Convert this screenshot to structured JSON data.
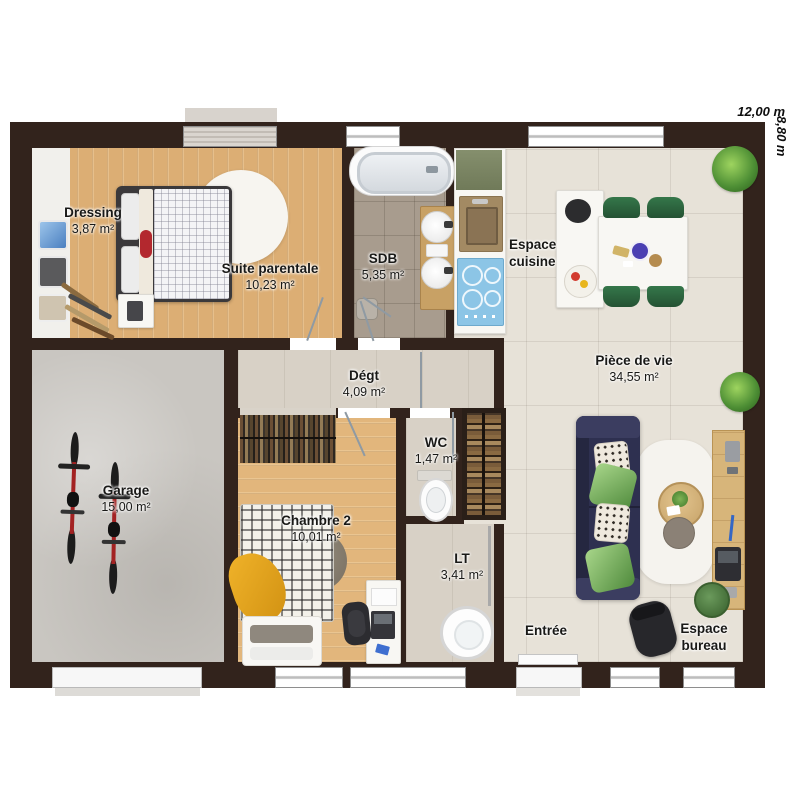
{
  "plan": {
    "dimension_width": "12,00 m",
    "dimension_height": "8,80 m",
    "rooms": [
      {
        "name": "Dressing",
        "area": "3,87 m²"
      },
      {
        "name": "Suite parentale",
        "area": "10,23 m²"
      },
      {
        "name": "SDB",
        "area": "5,35 m²"
      },
      {
        "name": "Espace cuisine",
        "area": ""
      },
      {
        "name": "Pièce de vie",
        "area": "34,55 m²"
      },
      {
        "name": "Dégt",
        "area": "4,09 m²"
      },
      {
        "name": "Garage",
        "area": "15,00 m²"
      },
      {
        "name": "Chambre 2",
        "area": "10,01 m²"
      },
      {
        "name": "WC",
        "area": "1,47 m²"
      },
      {
        "name": "LT",
        "area": "3,41 m²"
      },
      {
        "name": "Entrée",
        "area": ""
      },
      {
        "name": "Espace bureau",
        "area": ""
      }
    ],
    "colors": {
      "wall": "#32231c",
      "wood_floor": "#dcae74",
      "bathroom_tile": "#a89c8e",
      "living_floor": "#e7e2d8",
      "garage_floor": "#c9c6c1",
      "sofa_navy": "#2e3050",
      "dining_chair_green": "#2d6b3c",
      "cooktop_blue": "#8cc5e6",
      "counter_olive": "#7d8766",
      "accent_red": "#b3282e",
      "accent_yellow": "#e7a81c",
      "plant_green": "#4e8f35",
      "label_text": "#191917"
    }
  }
}
